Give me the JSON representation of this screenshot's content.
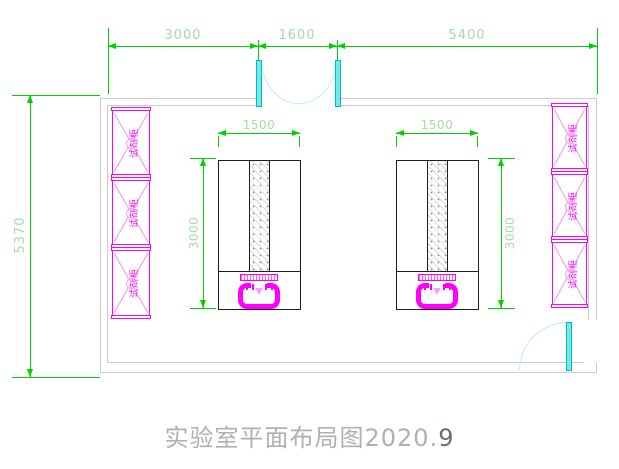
{
  "drawing": {
    "title_main": "实验室平面布局图2020.",
    "title_suffix": "9"
  },
  "dims": {
    "top_left": "3000",
    "top_mid": "1600",
    "top_right": "5400",
    "wall_left": "5370",
    "bench1_width": "1500",
    "bench1_depth": "3000",
    "bench2_width": "1500",
    "bench2_depth": "3000"
  },
  "cabinets": {
    "left": [
      "试剂柜",
      "试剂柜",
      "试剂柜"
    ],
    "right": [
      "试剂柜",
      "试剂柜",
      "试剂柜"
    ]
  },
  "colors": {
    "dimension_green": "#00cf00",
    "dimension_text_green": "#a5dca5",
    "cabinet_magenta": "#ff00ff",
    "door_cyan": "#74e9e9",
    "wall_gray": "#cbcbcb",
    "bench_black": "#1e1e1e",
    "title_gray": "#b0b0b0"
  }
}
